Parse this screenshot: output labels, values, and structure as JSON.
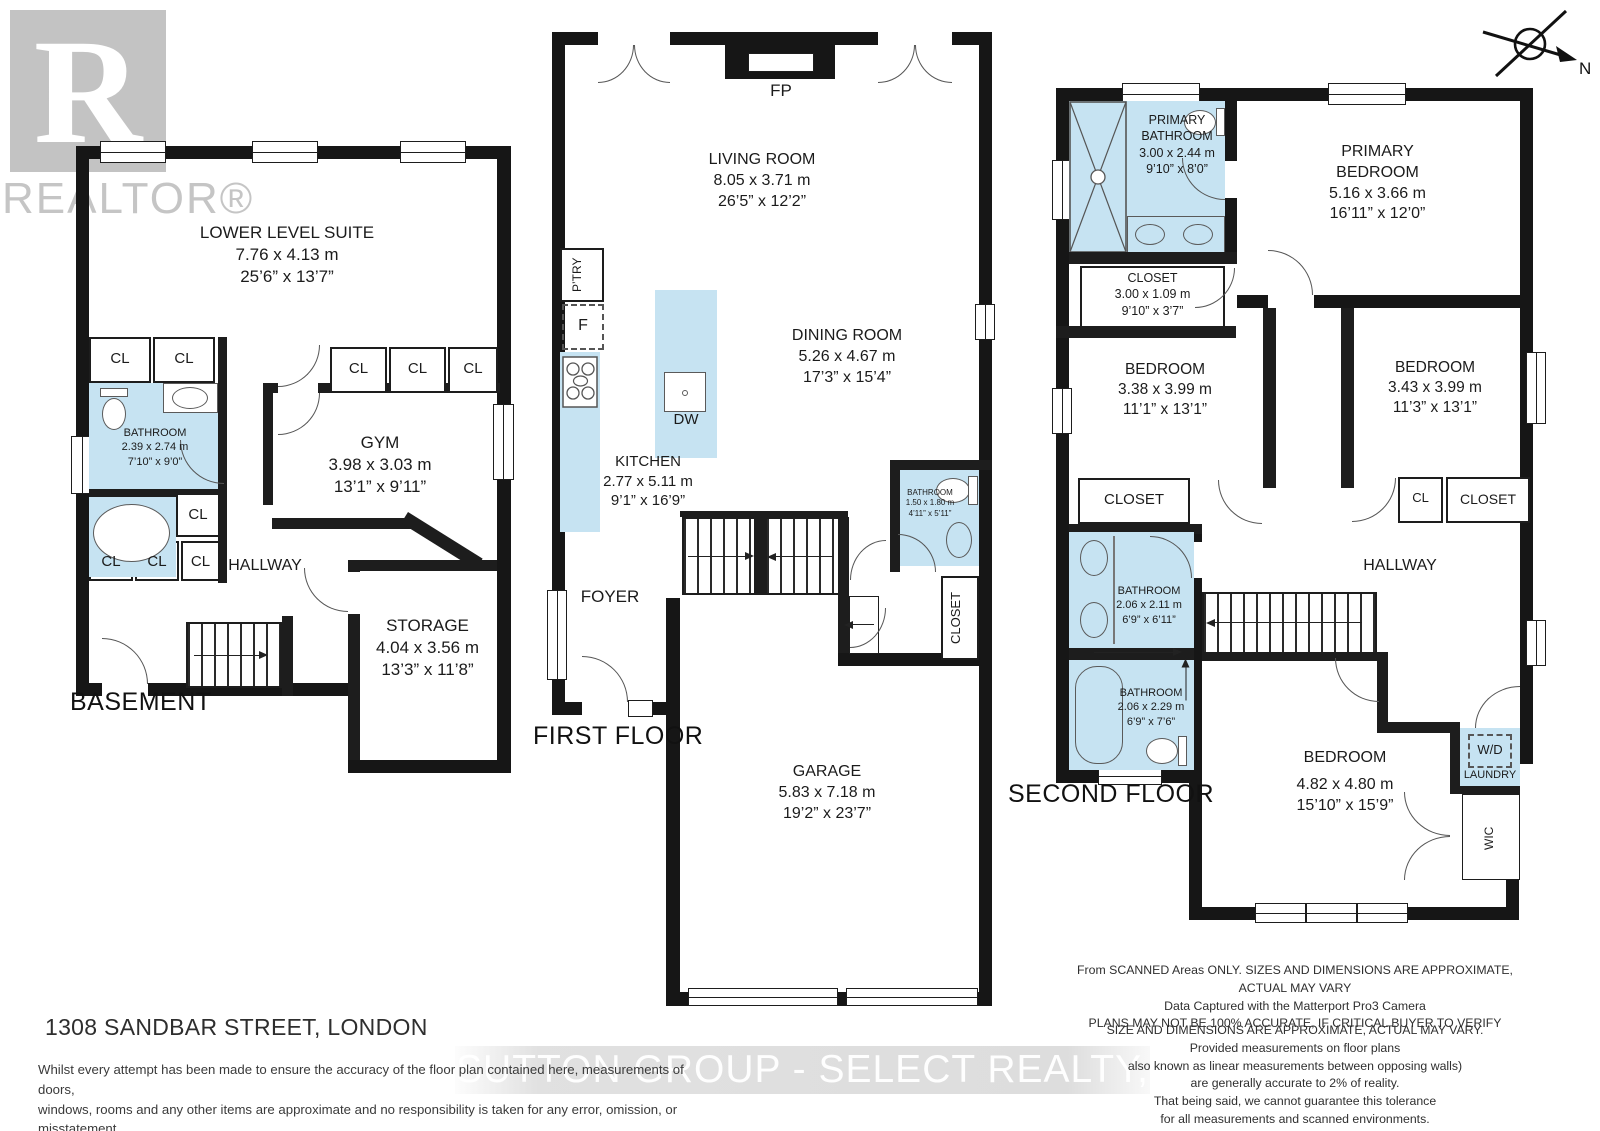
{
  "branding": {
    "realtor_r": "R",
    "realtor_wordmark": "REALTOR®",
    "compass_n": "N"
  },
  "watermark": "SUTTON GROUP - SELECT REALTY, Brokerage",
  "address": "1308 SANDBAR STREET, LONDON",
  "footer": {
    "left": [
      "Whilst every attempt has been made to ensure the accuracy of the floor plan contained here, measurements of doors,",
      "windows, rooms and any other items are approximate and no responsibility is taken for any error, omission, or misstatement.",
      "This plan is for illustrative purposes only and should be used as such by any prospective purchaser."
    ],
    "right1": [
      "From SCANNED Areas ONLY.  SIZES AND DIMENSIONS ARE APPROXIMATE, ACTUAL MAY VARY",
      "Data Captured with the Matterport Pro3 Camera",
      "PLANS MAY NOT BE 100% ACCURATE, IF CRITICAL BUYER TO VERIFY"
    ],
    "right2": [
      "SIZE AND DIMENSIONS ARE APPROXIMATE, ACTUAL MAY VARY.",
      "Provided measurements on floor plans",
      "also known as linear measurements between opposing walls)",
      "are generally accurate to 2% of reality.",
      "That being said, we cannot guarantee this tolerance",
      "for all measurements and scanned environments.",
      "PER Matterport.com"
    ]
  },
  "floors": {
    "basement": {
      "label": "BASEMENT",
      "rooms": {
        "suite": {
          "name": "LOWER LEVEL SUITE",
          "metric": "7.76 x 4.13 m",
          "imperial": "25’6” x 13’7”"
        },
        "bathroom": {
          "name": "BATHROOM",
          "metric": "2.39 x 2.74 m",
          "imperial": "7’10” x 9’0”"
        },
        "gym": {
          "name": "GYM",
          "metric": "3.98 x 3.03 m",
          "imperial": "13’1” x 9’11”"
        },
        "storage": {
          "name": "STORAGE",
          "metric": "4.04 x 3.56 m",
          "imperial": "13’3” x 11’8”"
        },
        "hallway": "HALLWAY",
        "cl": "CL"
      }
    },
    "first": {
      "label": "FIRST FLOOR",
      "rooms": {
        "living": {
          "name": "LIVING ROOM",
          "metric": "8.05 x 3.71 m",
          "imperial": "26’5” x 12’2”"
        },
        "dining": {
          "name": "DINING ROOM",
          "metric": "5.26 x 4.67 m",
          "imperial": "17’3” x 15’4”"
        },
        "kitchen": {
          "name": "KITCHEN",
          "metric": "2.77 x 5.11 m",
          "imperial": "9’1” x 16’9”"
        },
        "garage": {
          "name": "GARAGE",
          "metric": "5.83 x 7.18 m",
          "imperial": "19’2” x 23’7”"
        },
        "bathroom": {
          "name": "BATHROOM",
          "metric": "1.50 x 1.80 m",
          "imperial": "4’11” x 5’11”"
        },
        "foyer": "FOYER",
        "closet": "CLOSET",
        "fp": "FP",
        "dw": "DW",
        "fridge": "F",
        "pantry": "P’TRY"
      }
    },
    "second": {
      "label": "SECOND FLOOR",
      "rooms": {
        "primary_bath": {
          "name1": "PRIMARY",
          "name2": "BATHROOM",
          "metric": "3.00 x 2.44 m",
          "imperial": "9’10” x 8’0”"
        },
        "primary_bed": {
          "name1": "PRIMARY",
          "name2": "BEDROOM",
          "metric": "5.16 x 3.66 m",
          "imperial": "16’11” x 12’0”"
        },
        "primary_closet": {
          "name": "CLOSET",
          "metric": "3.00 x 1.09 m",
          "imperial": "9’10” x 3’7”"
        },
        "bed_left": {
          "name": "BEDROOM",
          "metric": "3.38 x 3.99 m",
          "imperial": "11’1” x 13’1”"
        },
        "bed_right": {
          "name": "BEDROOM",
          "metric": "3.43 x 3.99 m",
          "imperial": "11’3” x 13’1”"
        },
        "bath_top": {
          "name": "BATHROOM",
          "metric": "2.06 x 2.11 m",
          "imperial": "6’9” x 6’11”"
        },
        "bath_bottom": {
          "name": "BATHROOM",
          "metric": "2.06 x 2.29 m",
          "imperial": "6’9” x 7’6”"
        },
        "bed_bottom": {
          "name": "BEDROOM",
          "metric": "4.82 x 4.80 m",
          "imperial": "15’10” x 15’9”"
        },
        "hallway": "HALLWAY",
        "closet": "CLOSET",
        "cl": "CL",
        "wd": "W/D",
        "laundry": "LAUNDRY",
        "wic": "WIC"
      }
    }
  }
}
